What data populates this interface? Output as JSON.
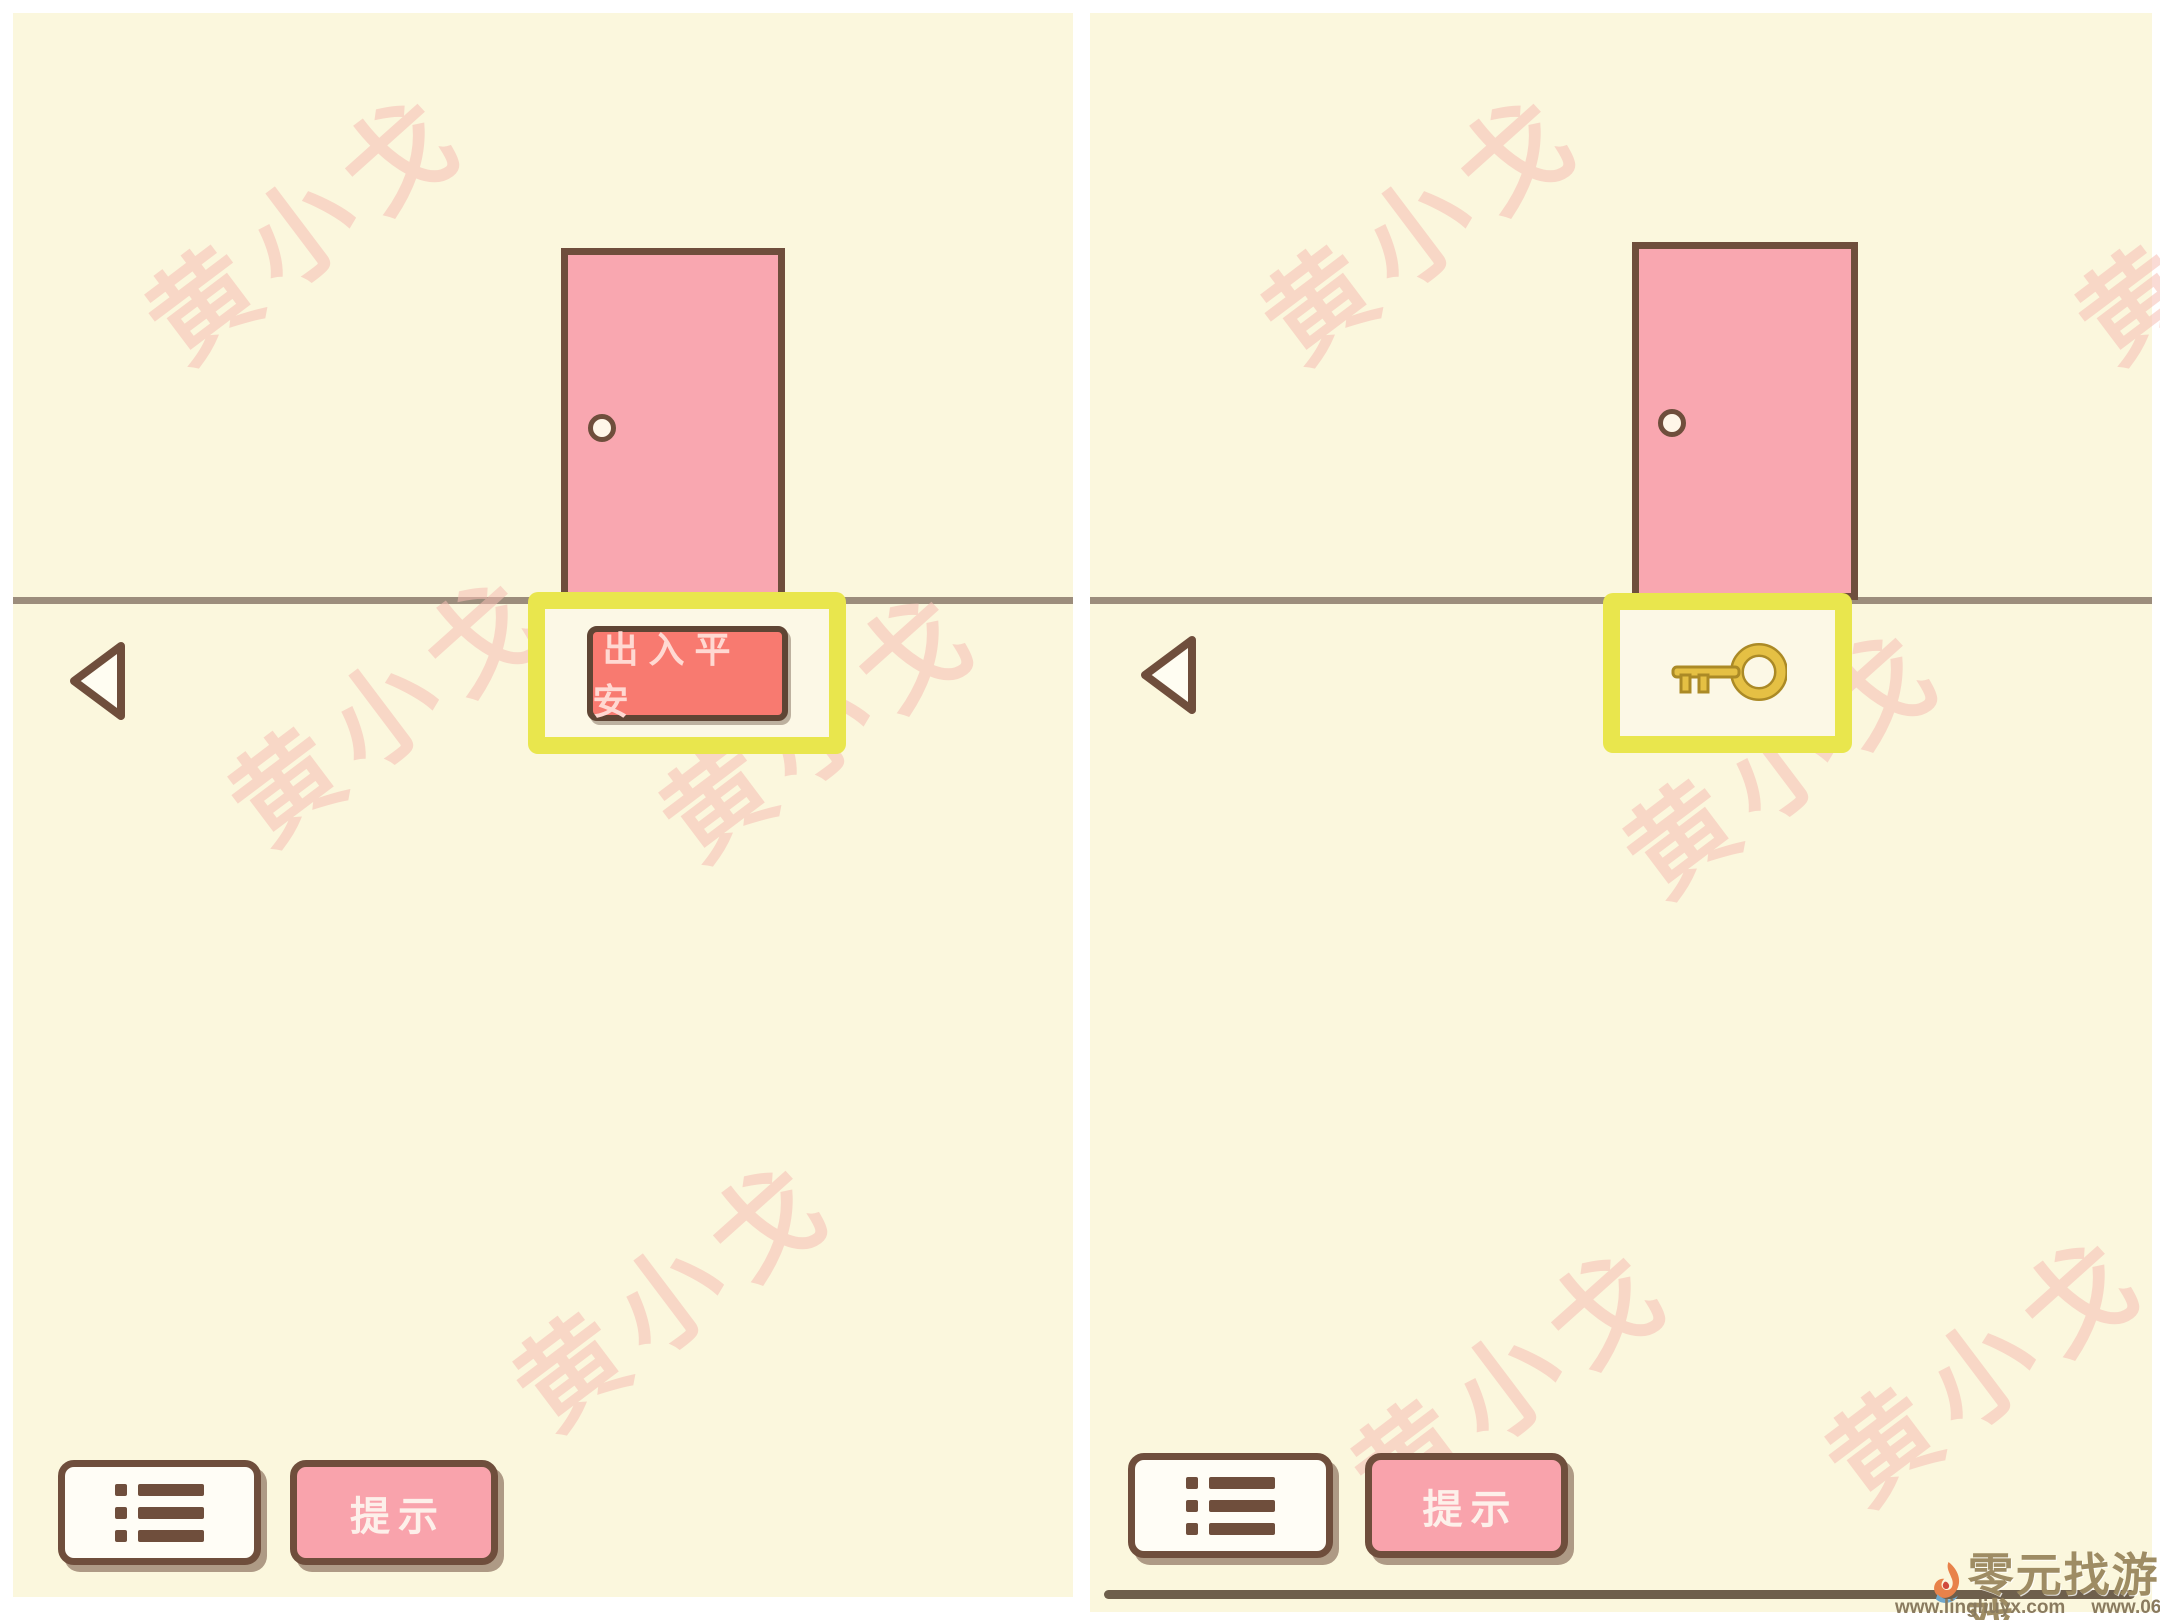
{
  "watermark": {
    "text": "黄小戈"
  },
  "panels": {
    "left": {
      "plaque_label": "出入平安",
      "hint_label": "提示"
    },
    "right": {
      "hint_label": "提示"
    }
  },
  "footer": {
    "site_name": "零元找游戏",
    "url_primary": "www.lingliuyx.com",
    "url_secondary": "www.06zyx.com"
  },
  "icons": {
    "back": "left-triangle-arrow",
    "menu": "bulleted-list",
    "highlight_item": "gold-key",
    "logo": "flame-swirl",
    "doorknob": "small-circle"
  },
  "colors": {
    "panel_background": "#fbf7dd",
    "door_pink": "#f9a7b0",
    "door_border_brown": "#6f4e3c",
    "highlight_yellow": "#e9e64d",
    "plaque_coral": "#f87a70",
    "hint_pink": "#f9a3ac",
    "key_gold": "#e5c044",
    "floor_line": "#9c8d7c"
  }
}
